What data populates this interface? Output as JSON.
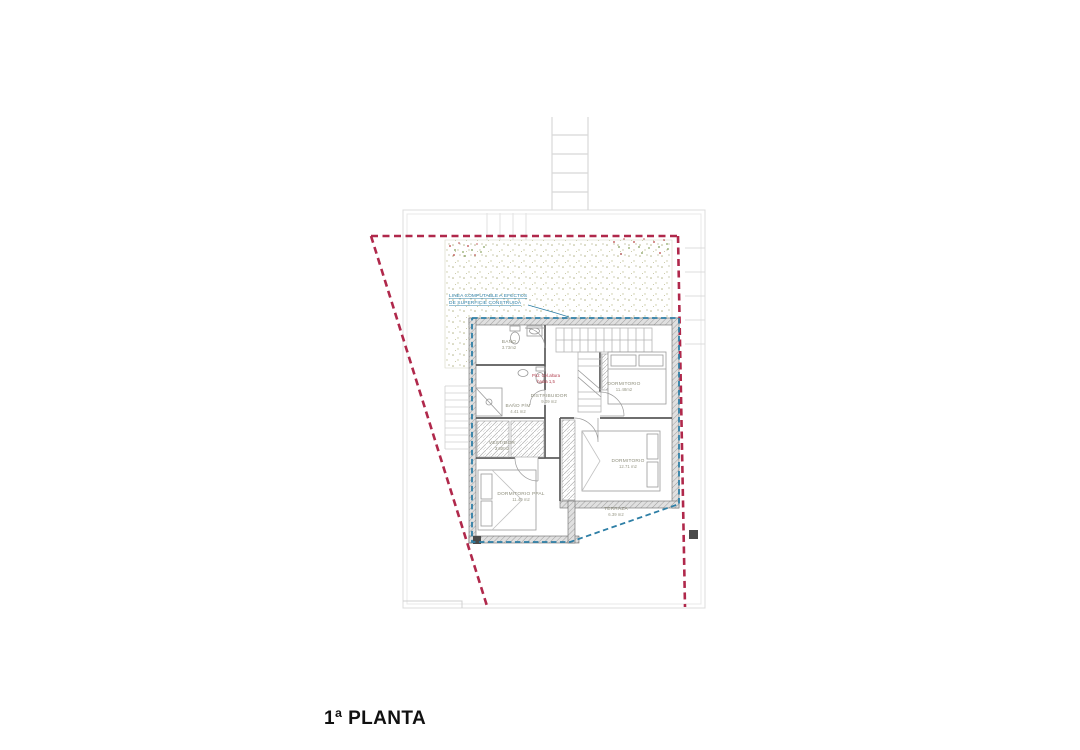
{
  "title": "1ª PLANTA",
  "plan": {
    "rooms": [
      {
        "id": "bano",
        "name": "BAÑO",
        "area": "3.73m2"
      },
      {
        "id": "bano_pm",
        "name": "BAÑO P/M",
        "area": "4.41 m2"
      },
      {
        "id": "distribuidor",
        "name": "DISTRIBUIDOR",
        "area": "9.09 m2"
      },
      {
        "id": "dormitorio_1",
        "name": "DORMITORIO",
        "area": "11.48m2"
      },
      {
        "id": "vestidor",
        "name": "VESTIDOR",
        "area": "3.60m2"
      },
      {
        "id": "dormitorio_ppal",
        "name": "DORMITORIO PPAL",
        "area": "11.40 m2"
      },
      {
        "id": "dormitorio_2",
        "name": "DORMITORIO",
        "area": "12.71 m2"
      },
      {
        "id": "terraza",
        "name": "TERRAZA",
        "area": "6.39 m2"
      }
    ],
    "annotations": {
      "computable_line": {
        "line1": "LINEA COMPUTABLE A EFECTOS",
        "line2": "DE SUPERFICIE CONSTRUIDA",
        "color": "#2e7fa6"
      },
      "height_note": {
        "line1": "P/U: Cel.altura",
        "line2": "hasta 1,5",
        "color": "#b03a4a"
      }
    },
    "colors": {
      "plot_boundary_red": "#b0284b",
      "computable_blue": "#2e7fa6",
      "walls": "#555555",
      "site_lines": "#d9d9d9",
      "garden_texture": "#b5b58a"
    }
  }
}
